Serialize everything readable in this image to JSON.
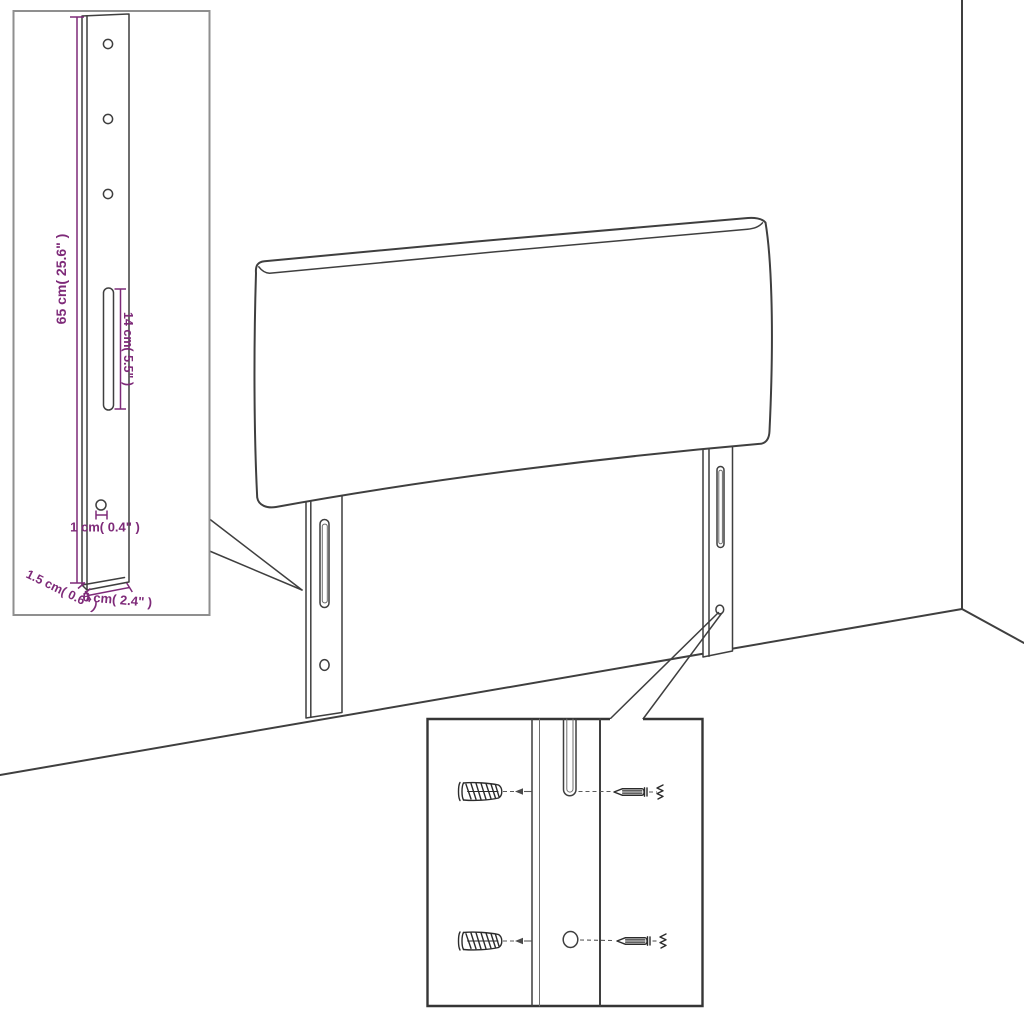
{
  "figure": {
    "type": "assembly-instruction-diagram",
    "subject": "upholstered headboard with mounting legs, wall plugs and screws"
  },
  "colors": {
    "background": "#ffffff",
    "line": "#3f3f3f",
    "dimension_accent": "#7e2a79",
    "inset_border_light": "#8f8f8f",
    "inset_border_dark": "#353535"
  },
  "dims": {
    "height": "65 cm( 25.6\" )",
    "slot": "14 cm( 5.5\" )",
    "hole": "1 cm( 0.4\" )",
    "depth": "1.5 cm( 0.6\" )",
    "width": "6 cm( 2.4\" )"
  }
}
